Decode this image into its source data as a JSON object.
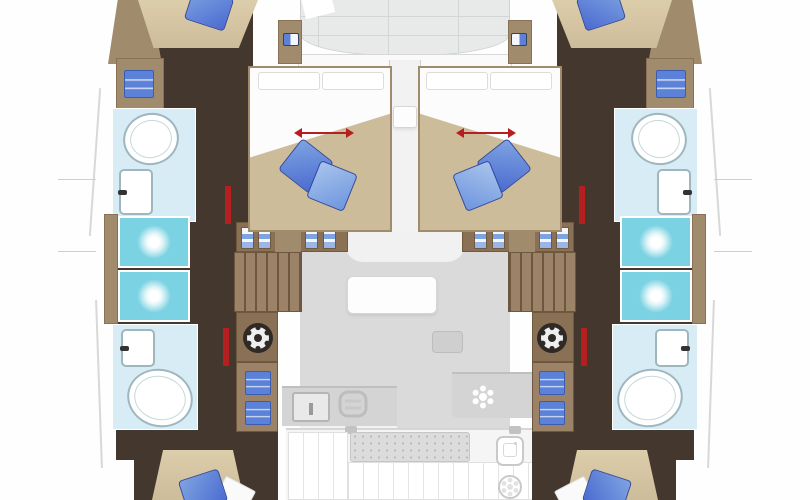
{
  "meta": {
    "diagram_type": "catamaran yacht deck / floor plan, top-down view, bow at top",
    "text_content": "none — the screenshot contains no written text",
    "symmetry": "port and starboard sides mirrored about vertical centerline"
  },
  "colors": {
    "walkway": "#44372e",
    "wall": "#a08b6d",
    "wood": "#8a7156",
    "stair": "#9c8266",
    "bedbeige": "#cdbc9a",
    "bathroom": "#d8ecf5",
    "shower": "#7ad2e2",
    "fixture": "#9eb7bf",
    "pillowdark": "#4a6bd0",
    "pillowlight": "#7fa3e2",
    "itemblue": "#5b82d8",
    "red": "#b51f1f",
    "deck": "#e8eaea",
    "salon": "#dadada",
    "counter": "#d4d4d4",
    "cockpit": "#f5f5f5"
  },
  "port_hull": {
    "rooms_bow_to_stern": [
      {
        "room": "bow-berth",
        "fixtures": [
          "mattress",
          "blue-pillow"
        ]
      },
      {
        "room": "wardrobe-locker",
        "fixtures": [
          "stored-linen"
        ]
      },
      {
        "room": "forward-bathroom",
        "fixtures": [
          "toilet",
          "washbasin"
        ]
      },
      {
        "room": "shower-stalls",
        "count": 2,
        "fixtures": [
          "shower-head",
          "shower-head"
        ]
      },
      {
        "room": "aft-bathroom",
        "fixtures": [
          "washbasin",
          "toilet"
        ]
      },
      {
        "room": "aft-cabin",
        "fixtures": [
          "double-berth",
          "blue-pillow",
          "sheet"
        ]
      }
    ],
    "passage_fixtures": [
      "hanging-lockers",
      "companionway-stairs",
      "ship-wheel",
      "drawer-unit",
      "red-door-markers"
    ]
  },
  "starboard_hull": {
    "note": "mirror image of port hull"
  },
  "forward_cabins": {
    "count": 2,
    "fixtures_each": [
      "island-double-bed",
      "two-head-pillows",
      "red-slide-arrow",
      "dark-blue-pillow",
      "light-blue-pillow"
    ]
  },
  "center_nacelle": {
    "bow_to_stern": [
      {
        "area": "foredeck-hatch-panel",
        "style": "gridded light panel, curved aft edge"
      },
      {
        "area": "entry-step-band"
      },
      {
        "area": "companionway-corridor",
        "fixtures": [
          "corridor-step"
        ]
      },
      {
        "area": "salon",
        "fixtures": [
          "front-seat",
          "side-table",
          "sofa"
        ]
      },
      {
        "area": "galley",
        "fixtures": [
          "galley-sink",
          "stove",
          "burner"
        ]
      },
      {
        "area": "cockpit",
        "fixtures": [
          "speckled-table",
          "slatted-bench",
          "cockpit-sink",
          "round-table"
        ]
      }
    ]
  }
}
